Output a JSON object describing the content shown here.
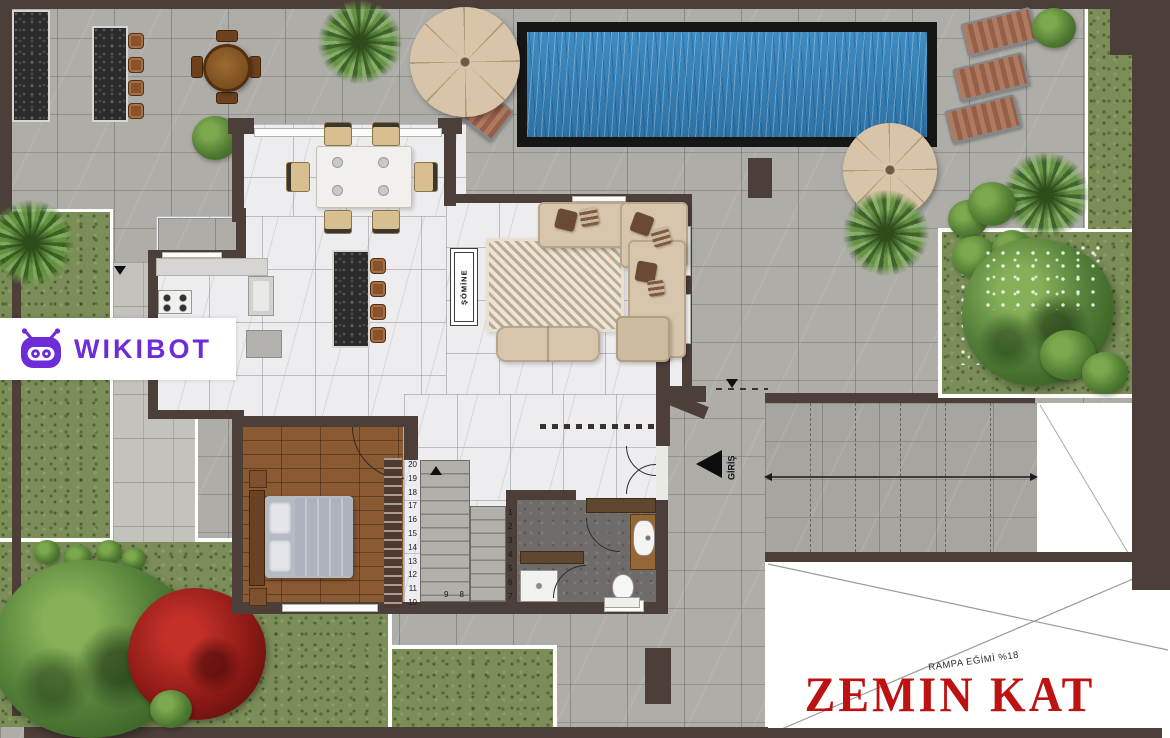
{
  "watermark": {
    "brand": "WIKIBOT"
  },
  "plan": {
    "floor_title": "ZEMIN KAT",
    "ramp_slope_label": "RAMPA EĞİMİ %18",
    "entrance_label": "GİRİŞ",
    "fireplace_label": "ŞÖMİNE",
    "stairs": {
      "left_flight_numbers": [
        "20",
        "19",
        "18",
        "17",
        "16",
        "15",
        "14",
        "13",
        "12",
        "11",
        "10"
      ],
      "landing_numbers": [
        "9",
        "8"
      ],
      "right_flight_numbers": [
        "1",
        "2",
        "3",
        "4",
        "5",
        "6",
        "7"
      ]
    }
  },
  "colors": {
    "brand_purple": "#6D2BD9",
    "title_red": "#BE1212",
    "wall_brown": "#4C3E39",
    "terrace_gray": "#AEADA8",
    "marble_white": "#EDEDEF",
    "grass_green": "#7B8E58",
    "pool_blue": "#3E8CC2",
    "pool_blue_deep": "#2D72A5",
    "wood_brown": "#8A5A33",
    "sofa_beige": "#D8C6AC",
    "umbrella_beige": "#D8C4A8",
    "granite_black": "#2B2B2B"
  }
}
